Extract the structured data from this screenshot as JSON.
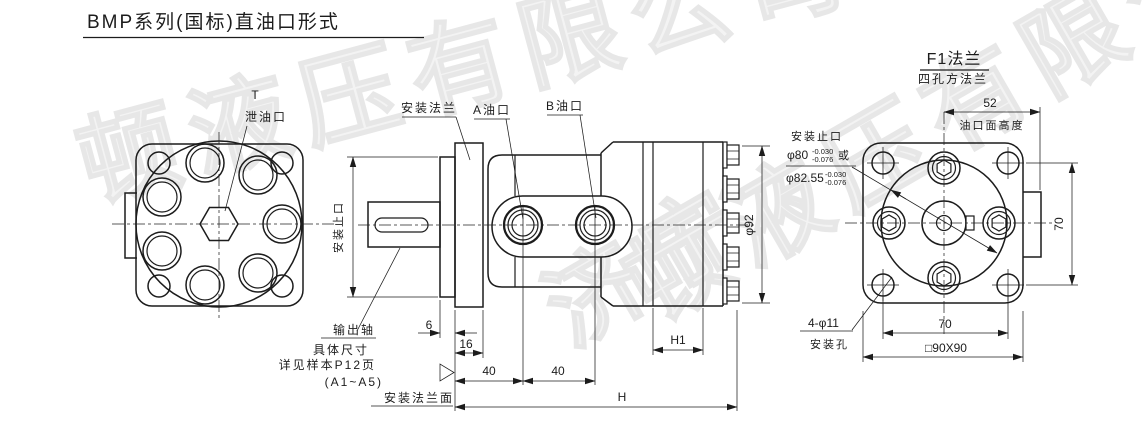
{
  "title": "BMP系列(国标)直油口形式",
  "watermarks": {
    "company": "顿液压有限公司",
    "city": "济宁"
  },
  "left_view": {
    "t_label": "T",
    "drain_label": "泄油口"
  },
  "middle_view": {
    "mounting_flange": "安装法兰",
    "port_a": "A油口",
    "port_b": "B油口",
    "spigot_vertical": "安装止口",
    "output_shaft": "输出轴",
    "shaft_note_1": "具体尺寸",
    "shaft_note_2": "详见样本P12页",
    "shaft_note_3": "(A1~A5)",
    "flange_face": "安装法兰面",
    "dim_6": "6",
    "dim_16": "16",
    "dim_40a": "40",
    "dim_40b": "40",
    "dim_h1": "H1",
    "dim_h": "H",
    "dim_body_dia": "φ92"
  },
  "right_view": {
    "heading": "F1法兰",
    "subheading": "四孔方法兰",
    "spigot_label": "安装止口",
    "spigot_dia_1": "φ80",
    "spigot_dia_1_tol_up": "-0.030",
    "spigot_dia_1_tol_dn": "-0.076",
    "or_word": "或",
    "spigot_dia_2": "φ82.55",
    "spigot_dia_2_tol_up": "-0.030",
    "spigot_dia_2_tol_dn": "-0.076",
    "mount_holes": "4-φ11",
    "mount_holes_label": "安装孔",
    "dim_52": "52",
    "port_face_height": "油口面高度",
    "dim_70_right": "70",
    "dim_70_bottom": "70",
    "dim_square": "□90X90"
  },
  "colors": {
    "line": "#1c1c1c",
    "watermark": "#e8e8e8",
    "background": "#ffffff"
  }
}
